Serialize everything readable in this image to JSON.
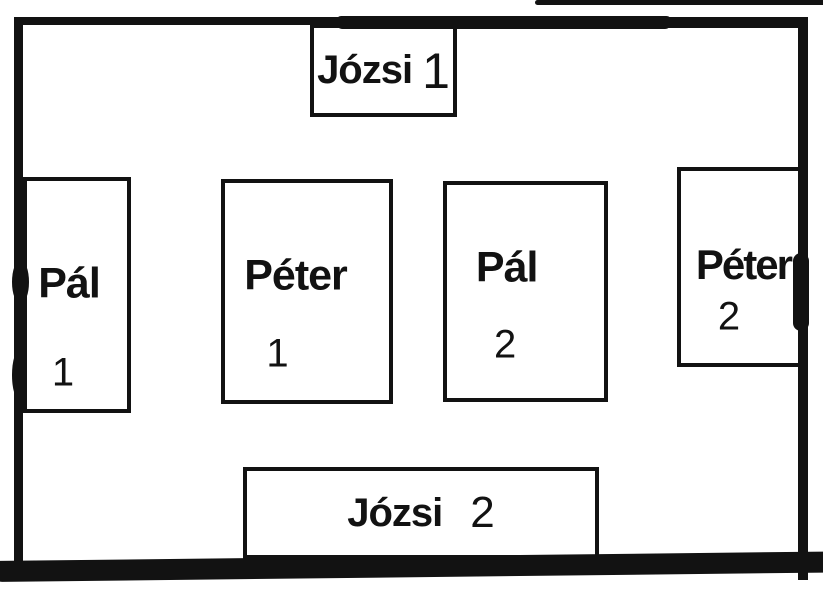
{
  "diagram": {
    "style": "hand-drawn plan with thick black marker frame",
    "ink_color": "#121212",
    "background_color": "#ffffff",
    "boxes": [
      {
        "label": "Józsi",
        "number": "1",
        "position": "top-center"
      },
      {
        "label": "Pál",
        "number": "1",
        "position": "middle-left"
      },
      {
        "label": "Péter",
        "number": "1",
        "position": "middle-center-left"
      },
      {
        "label": "Pál",
        "number": "2",
        "position": "middle-center-right"
      },
      {
        "label": "Péter",
        "number": "2",
        "position": "middle-right"
      },
      {
        "label": "Józsi",
        "number": "2",
        "position": "bottom-center"
      }
    ]
  }
}
